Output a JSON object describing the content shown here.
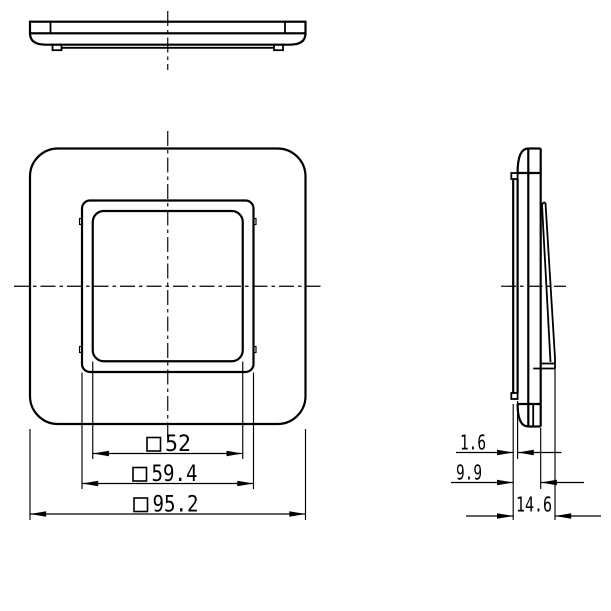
{
  "drawing": {
    "subject": "switch-cover-frame-three-view-drawing",
    "colors": {
      "line": "#000000",
      "background": "#ffffff"
    },
    "dimensions": {
      "front": [
        {
          "symbol": "□",
          "value": "52",
          "label": "□52"
        },
        {
          "symbol": "□",
          "value": "59.4",
          "label": "□59.4"
        },
        {
          "symbol": "□",
          "value": "95.2",
          "label": "□95.2"
        }
      ],
      "side": [
        {
          "value": "1.6",
          "label": "1.6"
        },
        {
          "value": "9.9",
          "label": "9.9"
        },
        {
          "value": "14.6",
          "label": "14.6"
        }
      ]
    }
  }
}
